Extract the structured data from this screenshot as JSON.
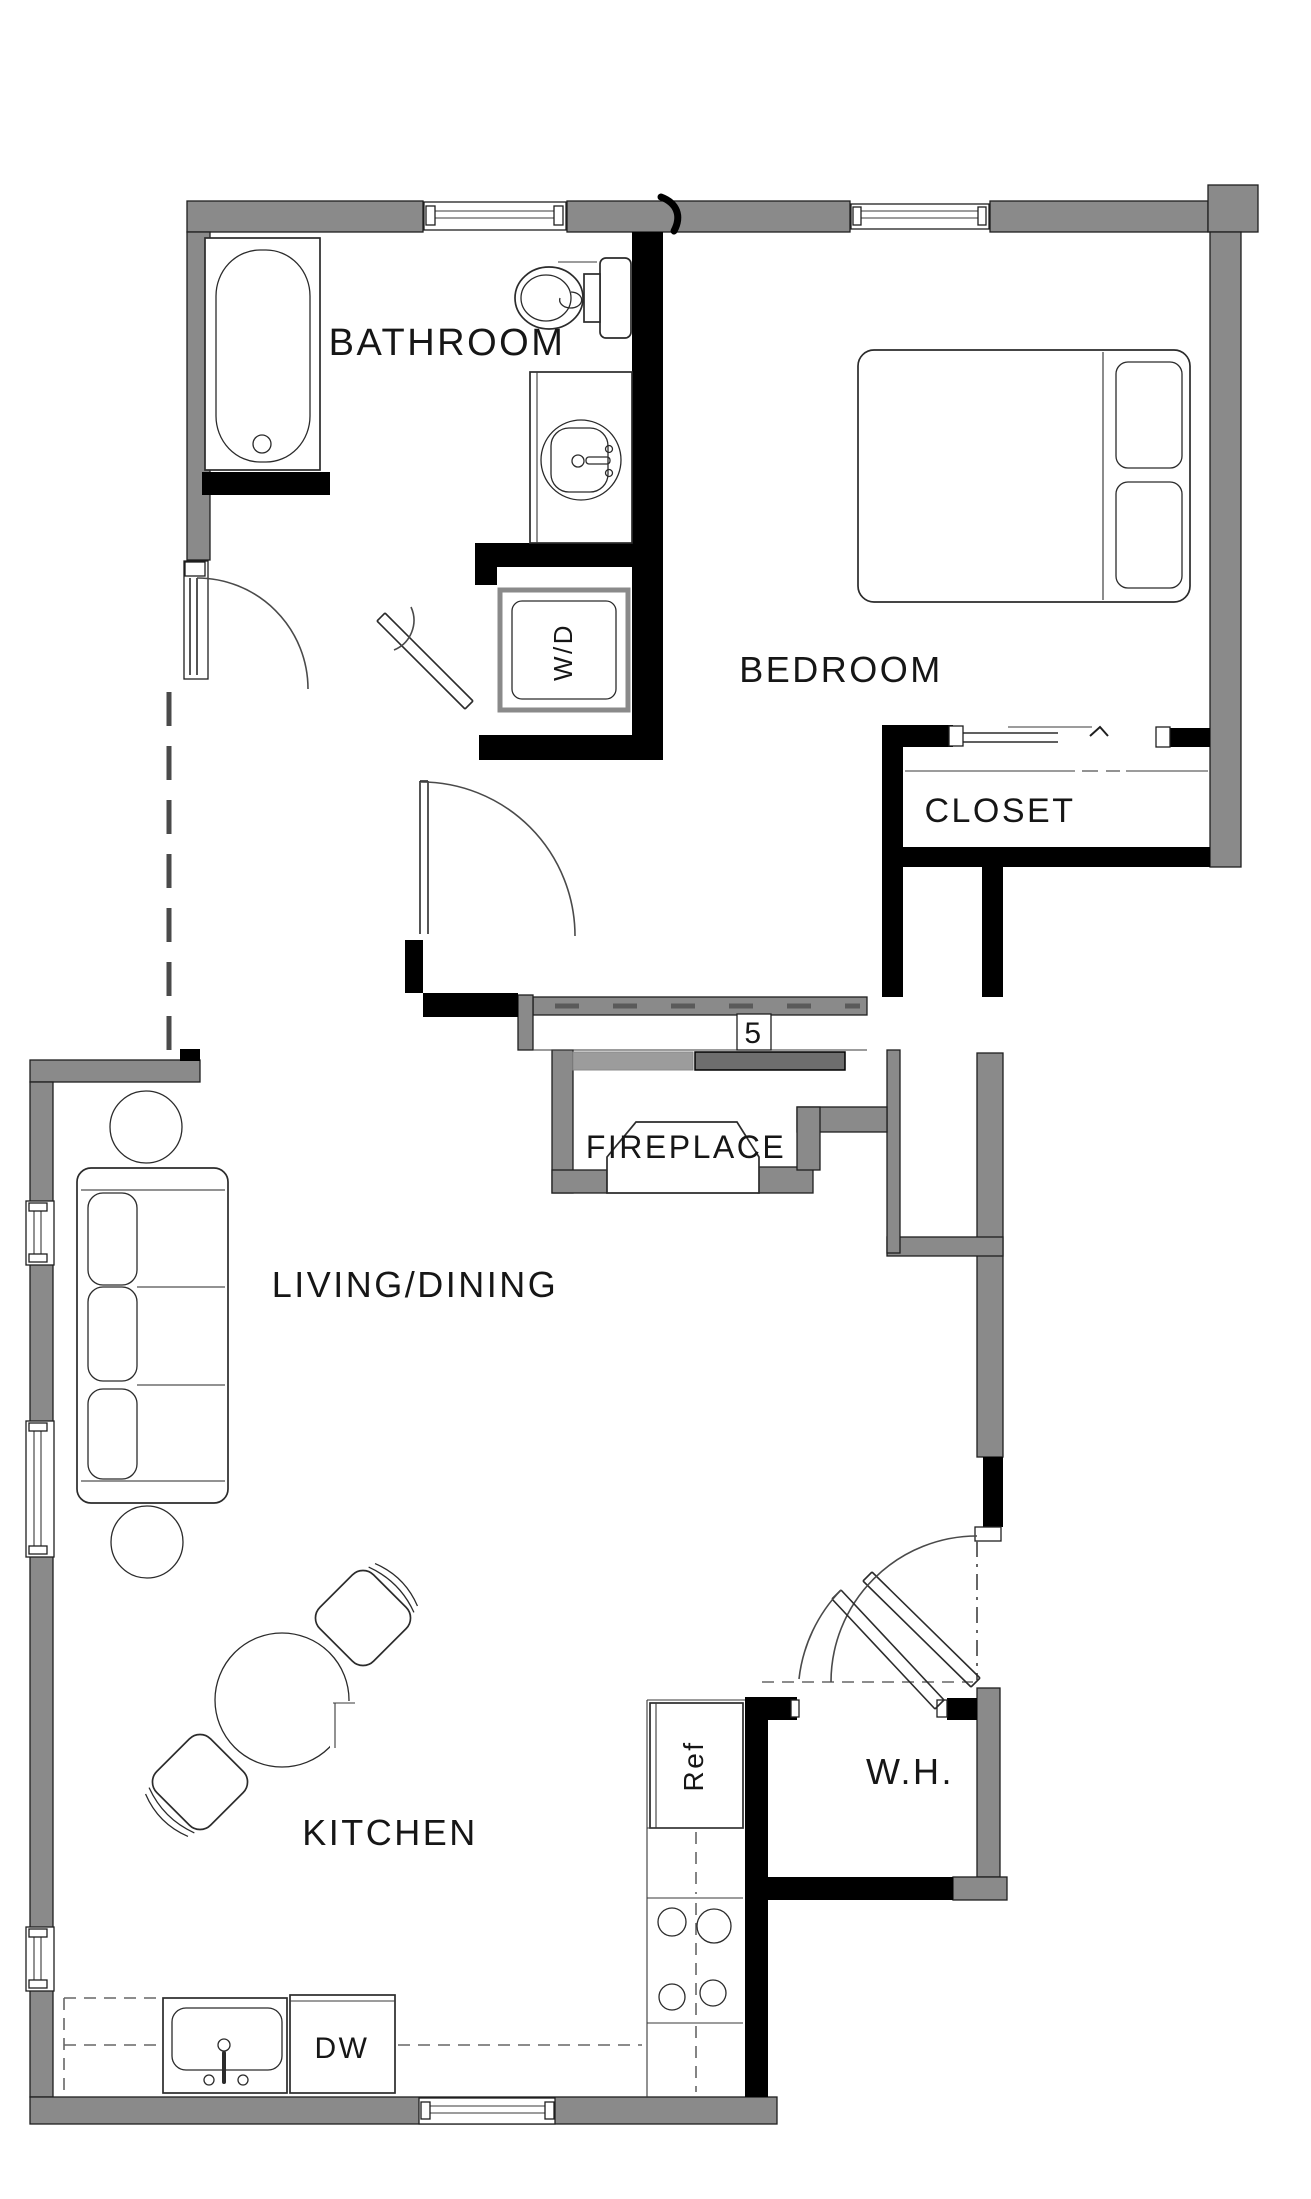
{
  "labels": {
    "bathroom": "BATHROOM",
    "bedroom": "BEDROOM",
    "closet": "CLOSET",
    "fireplace": "FIREPLACE",
    "living_dining": "LIVING/DINING",
    "kitchen": "KITCHEN",
    "water_heater": "W.H.",
    "washer_dryer": "W/D",
    "refrigerator": "Ref",
    "dishwasher": "DW",
    "door_number": "5"
  },
  "colors": {
    "exterior_wall": "#8a8a8a",
    "interior_wall": "#000000",
    "line": "#2b2b2b",
    "text": "#161616",
    "background": "#ffffff",
    "sliding_panel_dark": "#6e6e6e",
    "sliding_panel_light": "#9c9c9c"
  }
}
